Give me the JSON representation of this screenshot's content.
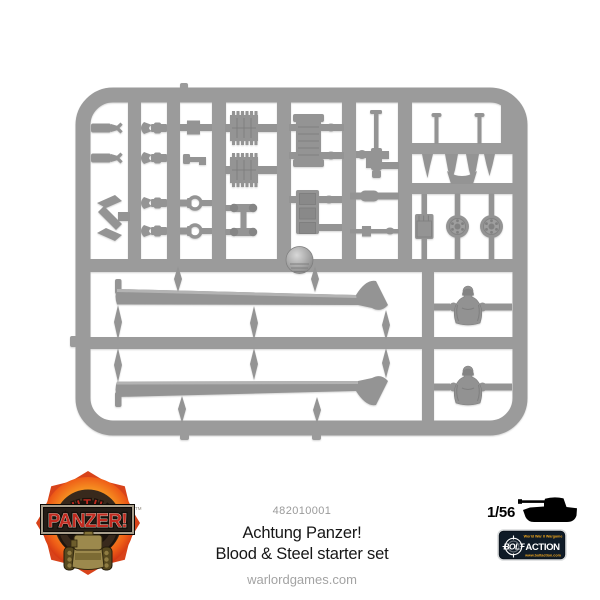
{
  "product": {
    "code": "482010001",
    "title": "Achtung Panzer!",
    "subtitle": "Blood & Steel starter set",
    "website": "warlordgames.com",
    "scale": "1/56"
  },
  "achtung_logo": {
    "arc_text": "ACHTUNG",
    "banner_text": "PANZER!",
    "trademark": "TM",
    "red": "#c22a20",
    "flame_orange": "#f08a1d"
  },
  "bolt_logo": {
    "tagline": "World War II Wargame",
    "word1": "BOLT",
    "word2": "ACTION",
    "url": "www.boltaction.com",
    "bg": "#0f1b27",
    "yellow": "#f2a71d"
  },
  "sprue": {
    "plastic_color": "#9b9b9b",
    "background": "#ffffff",
    "parts": [
      "tow-hook",
      "y-bracket",
      "clevis-fork",
      "small-box",
      "periscope",
      "shackle",
      "hatch-plate",
      "axle-wheel-set",
      "engine-grille",
      "stowage-box",
      "machine-gun",
      "silencer",
      "pull-rod",
      "barrel-pin",
      "muzzle-blade",
      "jerry-can",
      "road-wheel",
      "cupola-dome",
      "track-guard",
      "crew-figure"
    ]
  }
}
